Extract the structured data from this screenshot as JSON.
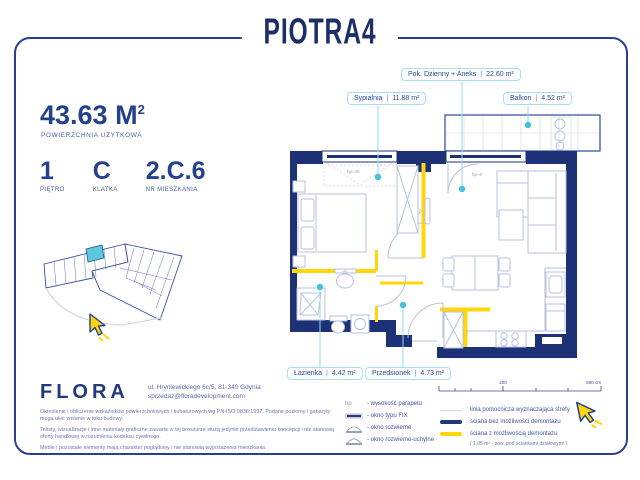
{
  "ui": {
    "pipe": "|"
  },
  "header": {
    "logo": "PIOTRA4"
  },
  "unit": {
    "area_value": "43.63 M",
    "area_sup": "2",
    "area_caption": "POWIERZCHNIA UŻYTKOWA",
    "floor_value": "1",
    "floor_label": "PIĘTRO",
    "stair_value": "C",
    "stair_label": "KLATKA",
    "apt_value": "2.C.6",
    "apt_label": "NR MIESZKANIA"
  },
  "rooms": {
    "sypialnia": {
      "name": "Sypialnia",
      "area": "11.88 m²"
    },
    "dzienny": {
      "name": "Pok. Dzienny + Aneks",
      "area": "22.60 m²"
    },
    "balkon": {
      "name": "Balkon",
      "area": "4.52 m²"
    },
    "lazienka": {
      "name": "Łazienka",
      "area": "4.42 m²"
    },
    "przedsionek": {
      "name": "Przedsionek",
      "area": "4.73 m²"
    }
  },
  "plan": {
    "hp_bedroom": "hp=45",
    "hp_living": "hp=0",
    "tv": "TV",
    "scale_mid": "200",
    "scale_end": "500 cm"
  },
  "footer": {
    "brand": "FLORA",
    "address": "ul. Hryniewickiego 6c/5, 81-340 Gdynia",
    "email": "sprzedaz@floradevelopment.com",
    "disclaimer1": "Określenie i obliczenie wskaźników powierzchniowych i kubaturowych wg PN-ISO 9836:1997. Podane poziomy i gabaryty mogą ulec zmianie w toku budowy.",
    "disclaimer2": "Teksty, wizualizacje i inne materiały graficzne zawarte w tej broszurze służą jedynie przedstawieniu koncepcji i nie stanowią oferty handlowej w rozumieniu kodeksu cywilnego.",
    "disclaimer3": "Meble i pozostałe elementy mają charakter poglądowy i nie stanowią wyposażenia mieszkania."
  },
  "legend": {
    "hp_symbol": "hp",
    "hp_label": "- wysokość parapetu",
    "fix_label": "- okno typu FIX",
    "casement_label": "- okno rozwierne",
    "tilt_label": "- okno rozwierno-uchylne",
    "aux_label": "linia pomocnicza wyznaczająca strefy",
    "wall_fixed_label": "ściana bez możliwości demontażu",
    "wall_demount_label": "ściana z możliwością demontażu",
    "wall_demount_note": "( 1.05 m² - pow. pod ściankami działowymi )"
  },
  "colors": {
    "navy": "#21387f",
    "yellow": "#ffd60a",
    "cyan": "#49c5da"
  }
}
